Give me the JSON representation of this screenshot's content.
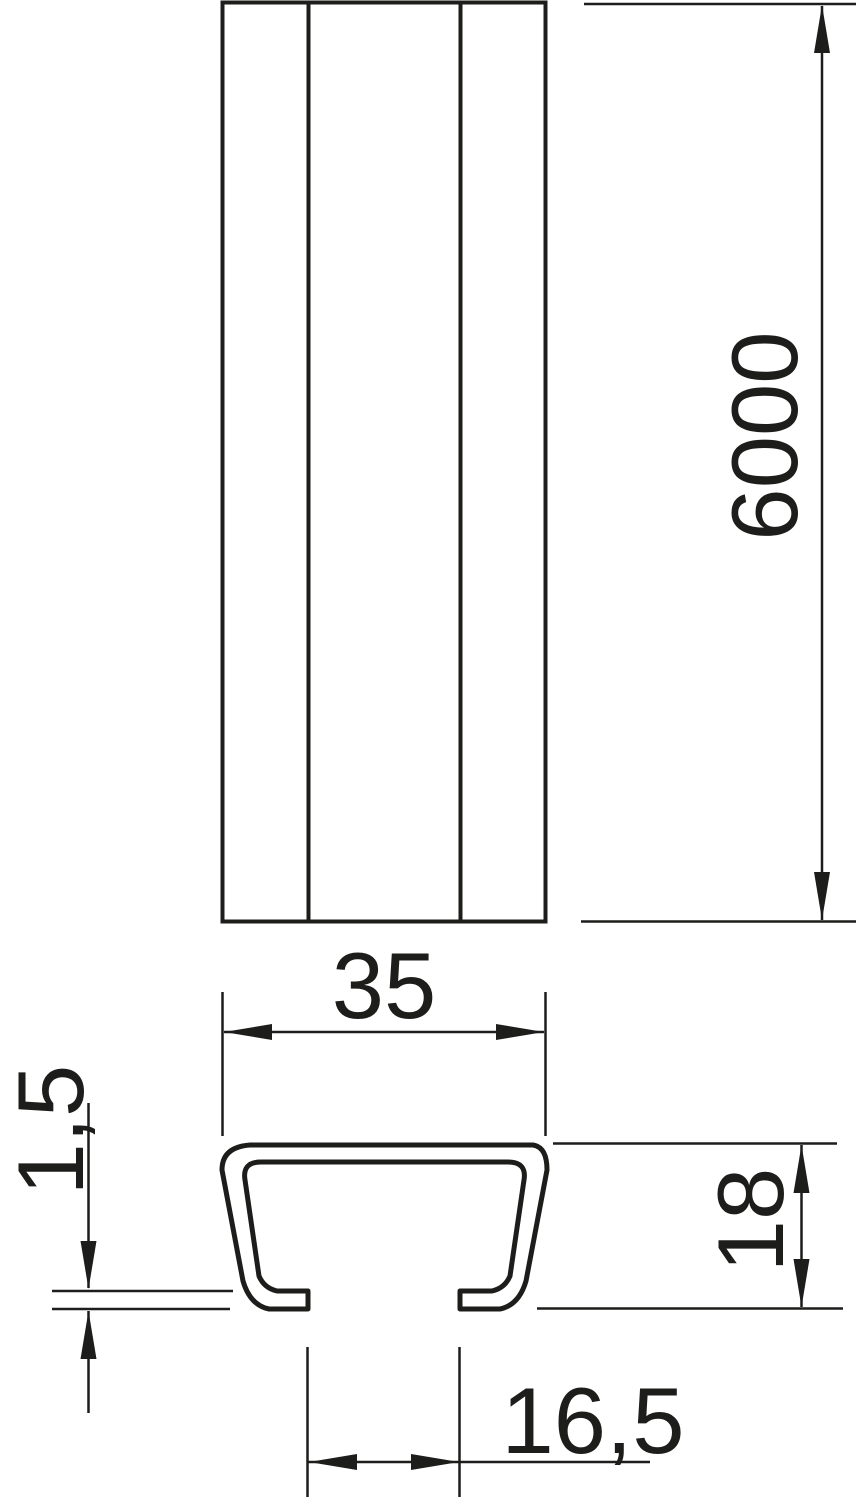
{
  "drawing": {
    "type": "technical-dimension-drawing",
    "subject": "c-profile-mounting-rail",
    "colors": {
      "line": "#1d1d1b",
      "background": "#ffffff"
    },
    "dimensions": {
      "length": "6000",
      "width": "35",
      "height": "18",
      "material_thickness": "1,5",
      "slot_opening": "16,5"
    }
  }
}
